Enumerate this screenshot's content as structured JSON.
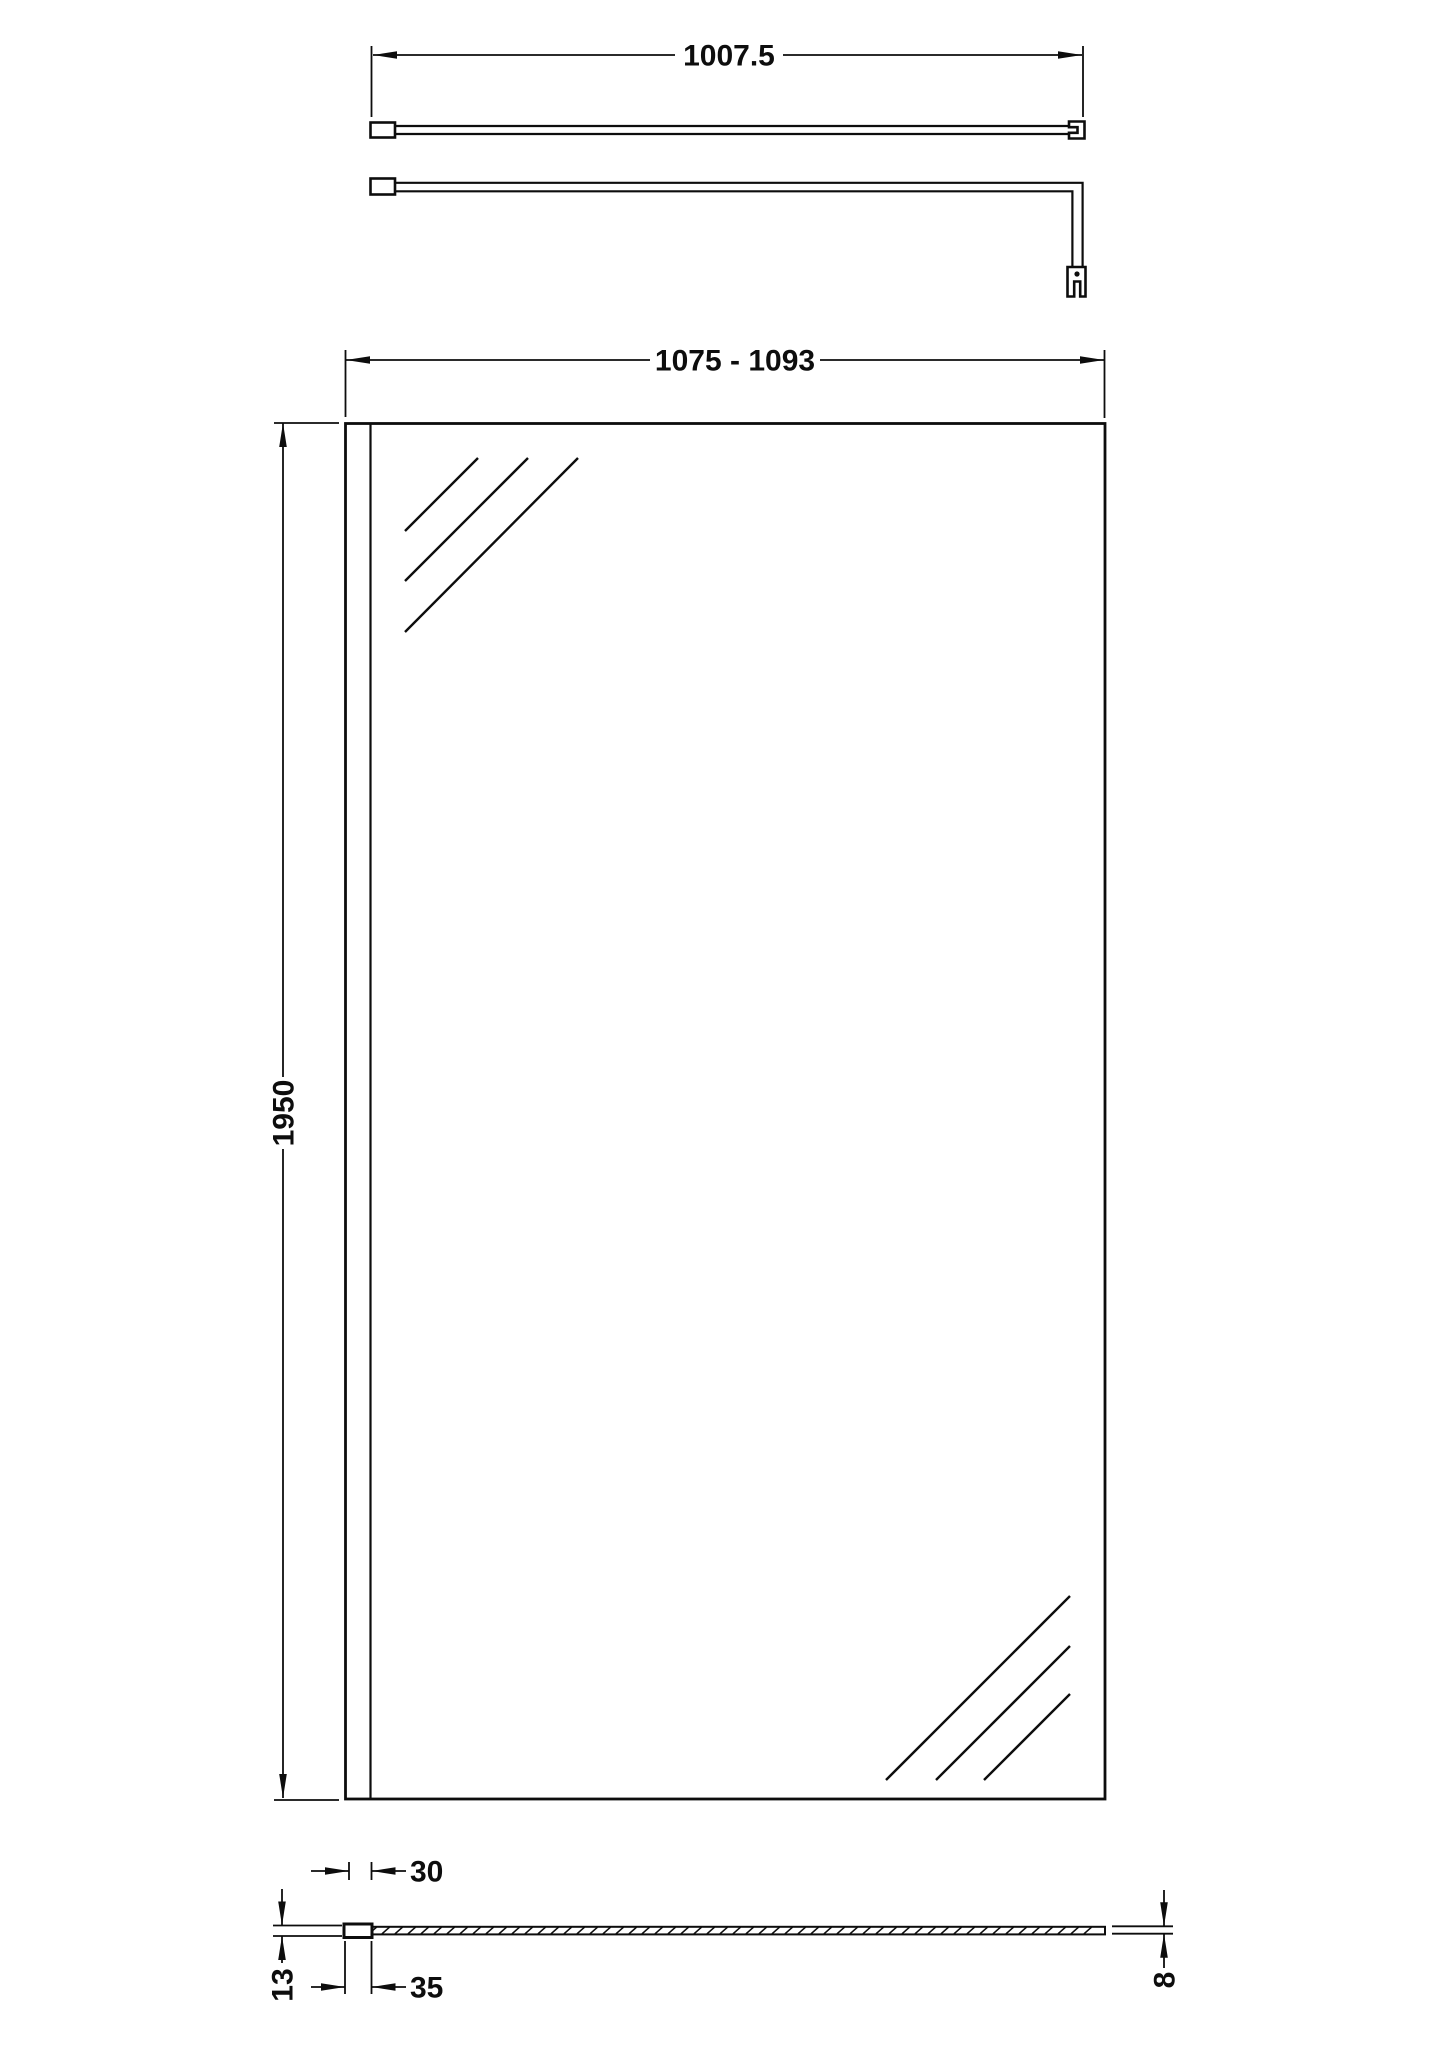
{
  "diagram": {
    "kind": "technical dimension drawing",
    "subject": "wetroom glass screen panel with wall profile and support arm",
    "colors": {
      "background": "#ffffff",
      "line": "#0d0d0d"
    },
    "labels": {
      "support_arm_length": "1007.5",
      "panel_width_range": "1075 - 1093",
      "panel_height": "1950",
      "profile_width": "30",
      "profile_depth": "35",
      "profile_thickness": "13",
      "glass_thickness": "8"
    }
  }
}
